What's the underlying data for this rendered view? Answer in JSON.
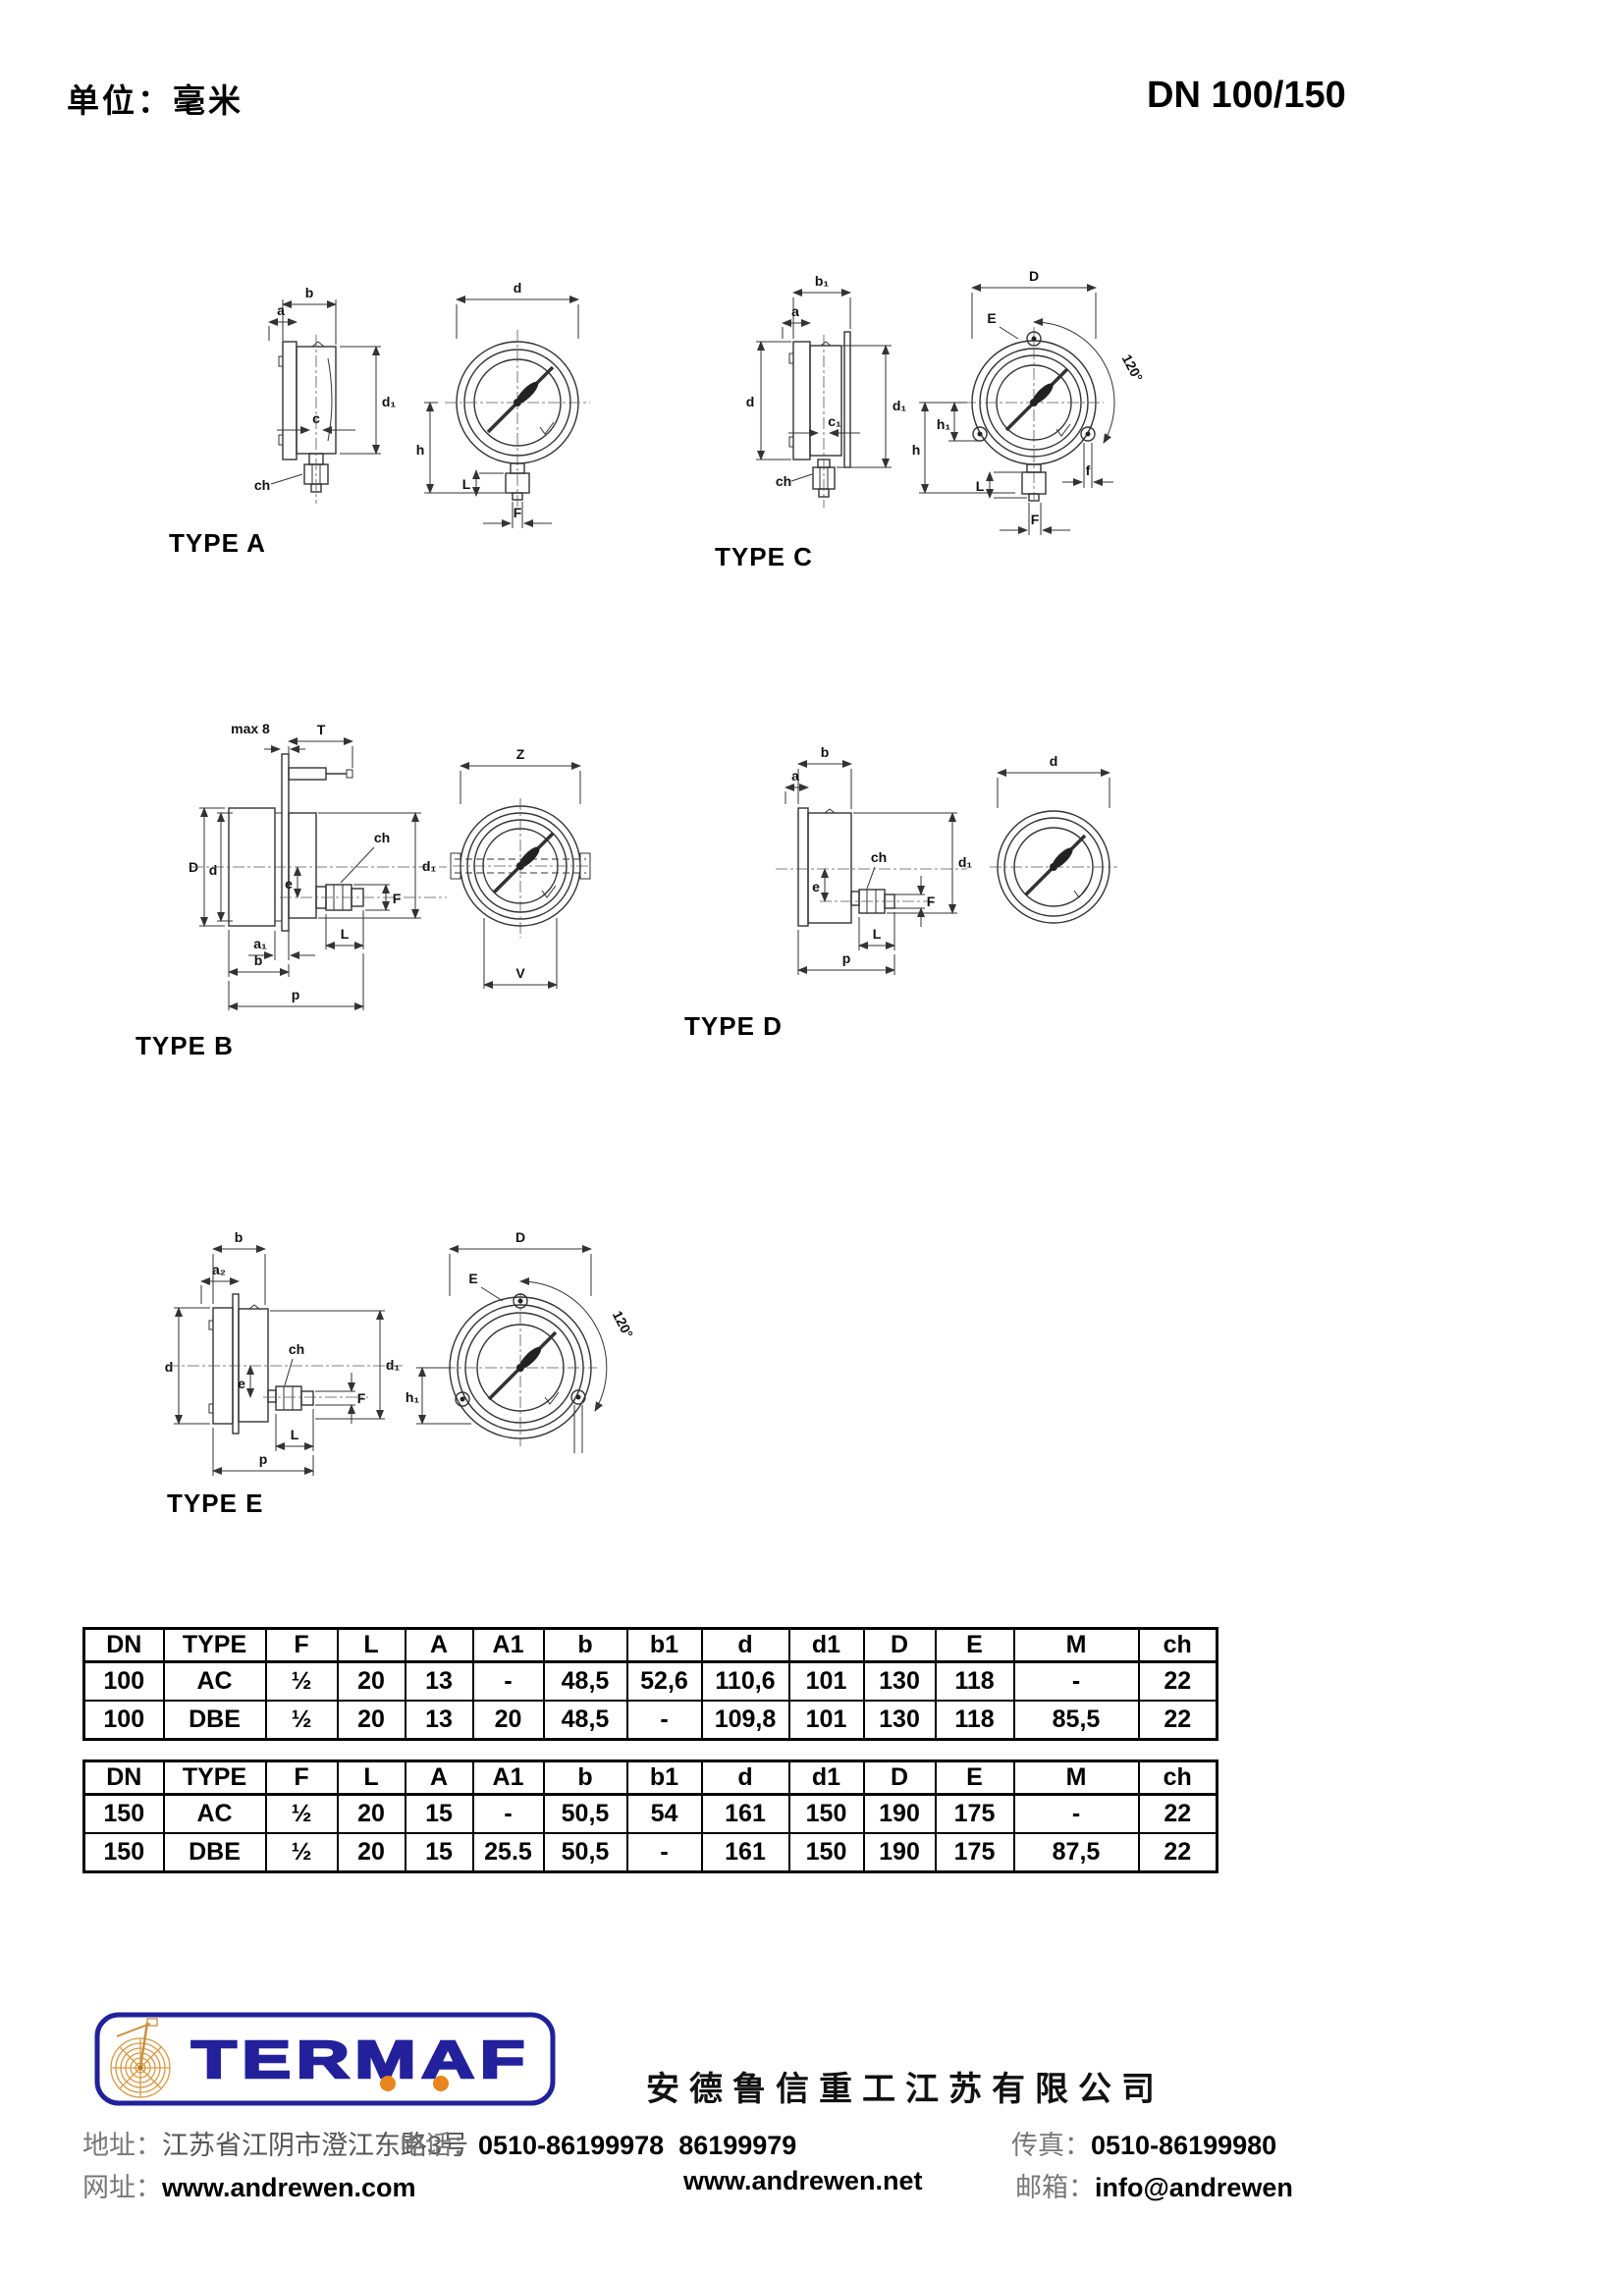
{
  "page": {
    "unit_label": "单位：毫米",
    "dn_label": "DN 100/150"
  },
  "drawings": {
    "type_a": {
      "caption": "TYPE A",
      "labels": {
        "b": "b",
        "a": "a",
        "c": "c",
        "d1": "d₁",
        "ch": "ch",
        "d": "d",
        "h": "h",
        "L": "L",
        "F": "F"
      }
    },
    "type_c": {
      "caption": "TYPE C",
      "labels": {
        "b1": "b₁",
        "a": "a",
        "d": "d",
        "c1": "c₁",
        "d1": "d₁",
        "ch": "ch",
        "D": "D",
        "E": "E",
        "angle": "120°",
        "h": "h",
        "h1": "h₁",
        "L": "L",
        "F": "F",
        "f": "f"
      }
    },
    "type_b": {
      "caption": "TYPE B",
      "labels": {
        "max8": "max 8",
        "T": "T",
        "D": "D",
        "d": "d",
        "ch": "ch",
        "d1": "d₁",
        "e": "e",
        "F": "F",
        "a1": "a₁",
        "L": "L",
        "b": "b",
        "p": "p",
        "Z": "Z",
        "V": "V"
      }
    },
    "type_d": {
      "caption": "TYPE D",
      "labels": {
        "b": "b",
        "a": "a",
        "ch": "ch",
        "e": "e",
        "F": "F",
        "d1": "d₁",
        "L": "L",
        "p": "p",
        "d": "d"
      }
    },
    "type_e": {
      "caption": "TYPE E",
      "labels": {
        "b": "b",
        "a2": "a₂",
        "d": "d",
        "ch": "ch",
        "e": "e",
        "F": "F",
        "d1": "d₁",
        "L": "L",
        "p": "p",
        "D": "D",
        "E": "E",
        "angle": "120°",
        "h1": "h₁"
      }
    }
  },
  "tables": [
    {
      "columns": [
        "DN",
        "TYPE",
        "F",
        "L",
        "A",
        "A1",
        "b",
        "b1",
        "d",
        "d1",
        "D",
        "E",
        "M",
        "ch"
      ],
      "rows": [
        [
          "100",
          "AC",
          "½",
          "20",
          "13",
          "-",
          "48,5",
          "52,6",
          "110,6",
          "101",
          "130",
          "118",
          "-",
          "22"
        ],
        [
          "100",
          "DBE",
          "½",
          "20",
          "13",
          "20",
          "48,5",
          "-",
          "109,8",
          "101",
          "130",
          "118",
          "85,5",
          "22"
        ]
      ]
    },
    {
      "columns": [
        "DN",
        "TYPE",
        "F",
        "L",
        "A",
        "A1",
        "b",
        "b1",
        "d",
        "d1",
        "D",
        "E",
        "M",
        "ch"
      ],
      "rows": [
        [
          "150",
          "AC",
          "½",
          "20",
          "15",
          "-",
          "50,5",
          "54",
          "161",
          "150",
          "190",
          "175",
          "-",
          "22"
        ],
        [
          "150",
          "DBE",
          "½",
          "20",
          "15",
          "25.5",
          "50,5",
          "-",
          "161",
          "150",
          "190",
          "175",
          "87,5",
          "22"
        ]
      ]
    }
  ],
  "footer": {
    "logo_text": "TERMAF",
    "company": "安德鲁信重工江苏有限公司",
    "address_label": "地址：",
    "address": "江苏省江阴市澄江东路3号",
    "phone_label": "电话：",
    "phone": "0510-86199978  86199979",
    "fax_label": "传真：",
    "fax": "0510-86199980",
    "web_label": "网址：",
    "web1": "www.andrewen.com",
    "web2": "www.andrewen.net",
    "email_label": "邮箱：",
    "email": "info@andrewen",
    "colors": {
      "navy": "#22219b",
      "orange": "#e8861d"
    }
  }
}
